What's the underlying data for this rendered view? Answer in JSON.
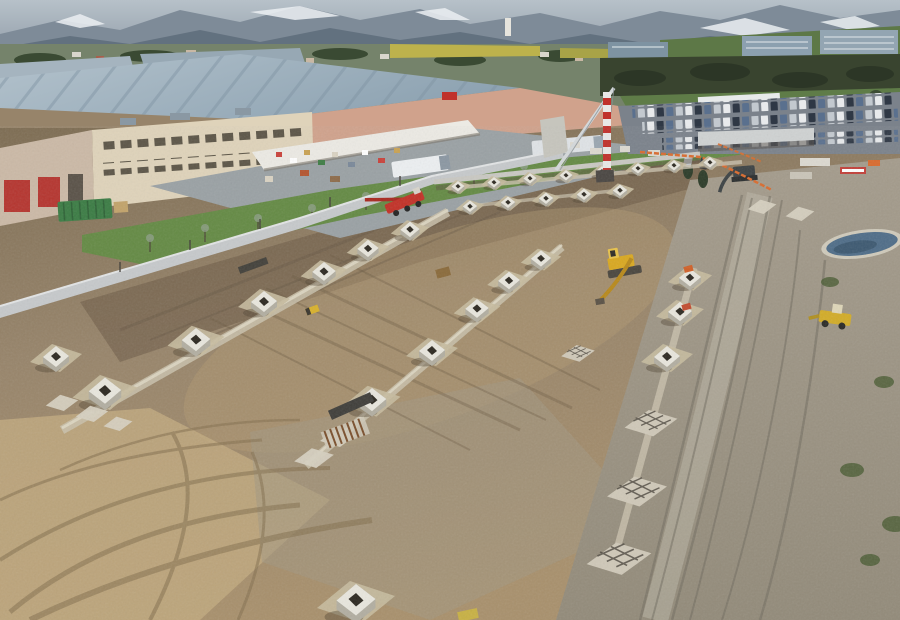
{
  "meta": {
    "type": "aerial-drone-photograph",
    "subject": "Aerial view of a construction site: excavated foundation field with rows of concrete pier footings, bordered by an industrial warehouse complex, a full parking lot, fields, a town and snow-capped mountains in the distance"
  },
  "objects": {
    "footing_rows": 4,
    "machines": [
      "tower crane with red-white mast",
      "red mobile crane",
      "yellow excavator",
      "yellow wheel loader",
      "dark excavator at trench"
    ],
    "buildings": [
      "industrial warehouse with gray roof",
      "cream office facade with two window rows",
      "retail yard with white canopy",
      "red loading doors"
    ],
    "site_features": [
      "grade beams connecting footings",
      "rebar mats on pads",
      "formwork and rebar cages",
      "orange safety fencing",
      "boundary wall",
      "gravel haul road with tire tracks",
      "mud area with curved tracks",
      "water pond with tarp",
      "green dumpster",
      "grass strip with bare trees"
    ],
    "background": [
      "snow-capped mountains",
      "wooded hills",
      "town with houses and campanile",
      "yellow fields",
      "office blocks",
      "parking lot full of cars"
    ]
  },
  "palette": {
    "haze": "#b7c1c9",
    "mountain_far": "#7e8b98",
    "mountain_near": "#5f6e7c",
    "snow": "#ebeff2",
    "valley_green": "#75836b",
    "tree_dark": "#3a4a33",
    "field_yellow": "#bdb24c",
    "hill_green": "#5d7847",
    "office_block": "#8ca0af",
    "hedge_dark": "#39442f",
    "slope_grass": "#5f7c48",
    "parking_asphalt": "#7b828b",
    "canopy_white": "#e7eaea",
    "roof_light": "#b3c2cc",
    "roof_shade": "#8ea3b2",
    "fascia_salmon": "#d0a28c",
    "sign_red": "#c0312b",
    "office_cream": "#dfd3ba",
    "window_dark": "#453f33",
    "door_red": "#b5352f",
    "yard_asphalt": "#9aa1a4",
    "dumpster_green": "#3b7c44",
    "grass": "#648a44",
    "wall_light": "#c6c9cb",
    "bank_dark": "#6b5a45",
    "dirt_dark": "#7d6c52",
    "dirt_mid": "#97846a",
    "dirt_light": "#a8906c",
    "mud_tan": "#c2aa80",
    "gravel": "#a09a8c",
    "track_brown": "#84704f",
    "track_gray": "#6f6a5e",
    "concrete_top": "#e8e6dd",
    "concrete_side": "#b2aea1",
    "slab": "#c7bb9f",
    "beam": "#c9c1ac",
    "hole_dark": "#2d2921",
    "crane_red": "#c23127",
    "machine_yellow": "#d9a820",
    "loader_yellow": "#d2ac28",
    "fence_orange": "#d96b2e",
    "pond_blue": "#4f6d88",
    "rebar_brown": "#7a4f2c",
    "truck_white": "#eceff1",
    "car_white": "#e8eaec",
    "car_dark": "#2f3845",
    "car_blue": "#5a708e",
    "car_silver": "#c3c9cf"
  }
}
